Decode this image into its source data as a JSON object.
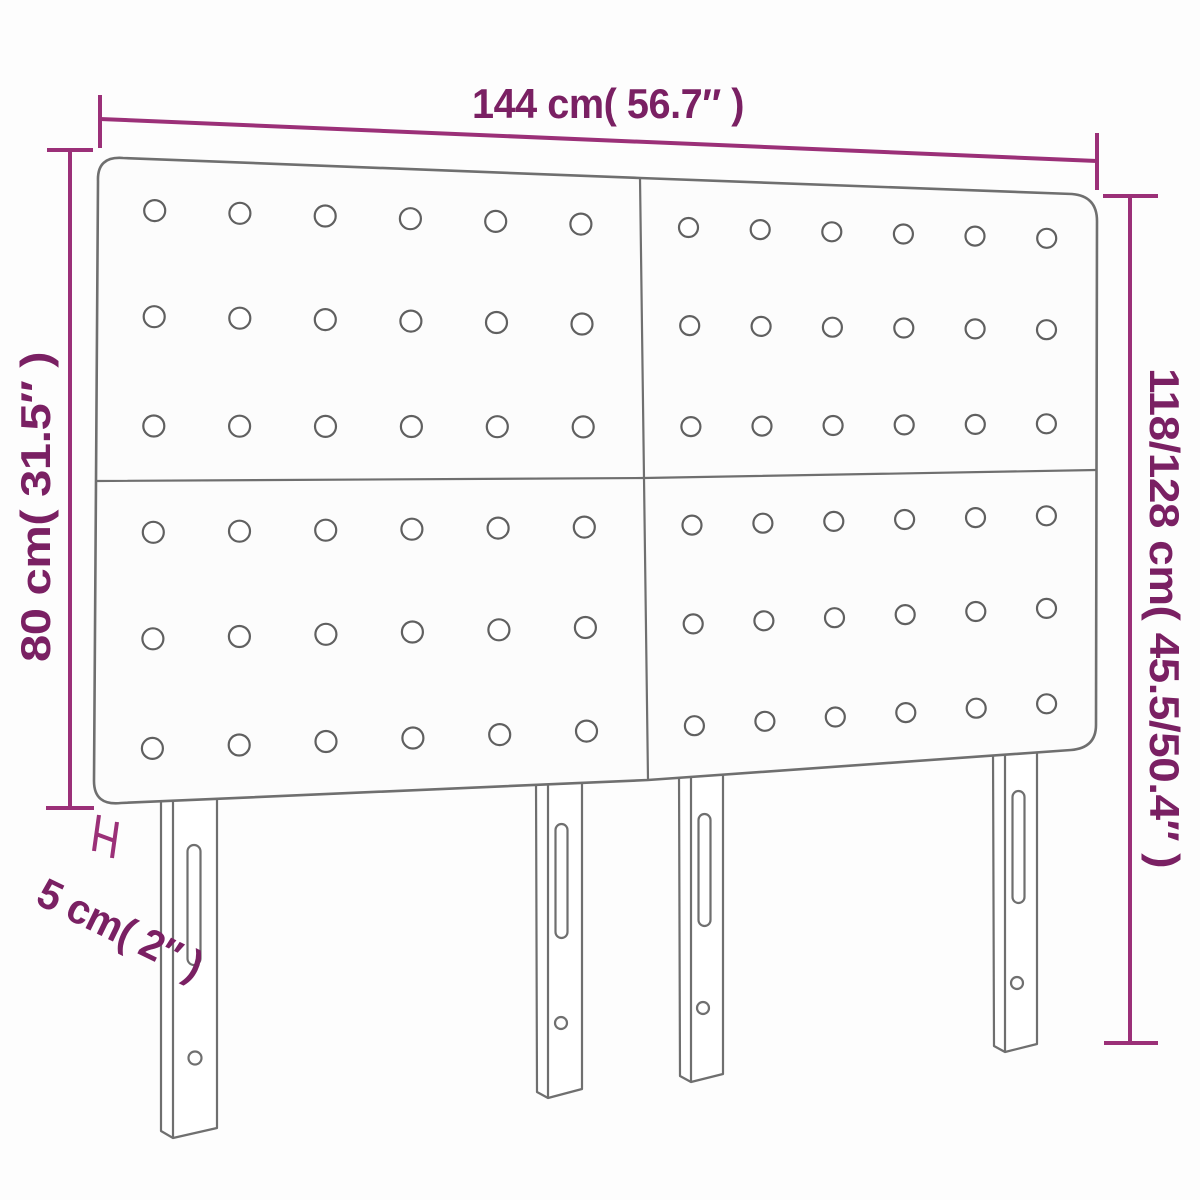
{
  "meta": {
    "type": "product-dimension-diagram",
    "subject": "Upholstered headboard with 4 tufted panels and 4 slotted legs"
  },
  "labels": {
    "width_top": "144 cm( 56.7″ )",
    "height_left": "80 cm( 31.5″ )",
    "height_right": "118/128 cm( 45.5/50.4″ )",
    "depth_bottom_left": "5 cm( 2″ )"
  },
  "colors": {
    "dimension_text": "#7a2063",
    "dimension_line": "#9b3078",
    "figure_outline": "#6f6f6f",
    "button_outline": "#606060",
    "panel_fill": "#fcfcfc",
    "background": "#fdfdfd"
  },
  "figure": {
    "panel_grid": {
      "rows": 2,
      "cols": 2
    },
    "buttons": {
      "rows_per_panel": 3,
      "cols_per_panel": 6,
      "total": 72
    },
    "button_margins": {
      "u0": 0.105,
      "u1": 0.89,
      "v": [
        0.16,
        0.49,
        0.83
      ]
    },
    "panel_quads": [
      {
        "tl": [
          98,
          157
        ],
        "tr": [
          640,
          178
        ],
        "br": [
          644,
          478
        ],
        "bl": [
          96,
          481
        ],
        "r": 10.5
      },
      {
        "tl": [
          640,
          178
        ],
        "tr": [
          1097,
          196
        ],
        "br": [
          1096,
          470
        ],
        "bl": [
          644,
          478
        ],
        "r": 9.5
      },
      {
        "tl": [
          96,
          481
        ],
        "tr": [
          644,
          478
        ],
        "br": [
          648,
          780
        ],
        "bl": [
          94,
          806
        ],
        "r": 10.5
      },
      {
        "tl": [
          644,
          478
        ],
        "tr": [
          1096,
          470
        ],
        "br": [
          1096,
          748
        ],
        "bl": [
          648,
          780
        ],
        "r": 9.5
      }
    ],
    "legs_count": 4
  }
}
